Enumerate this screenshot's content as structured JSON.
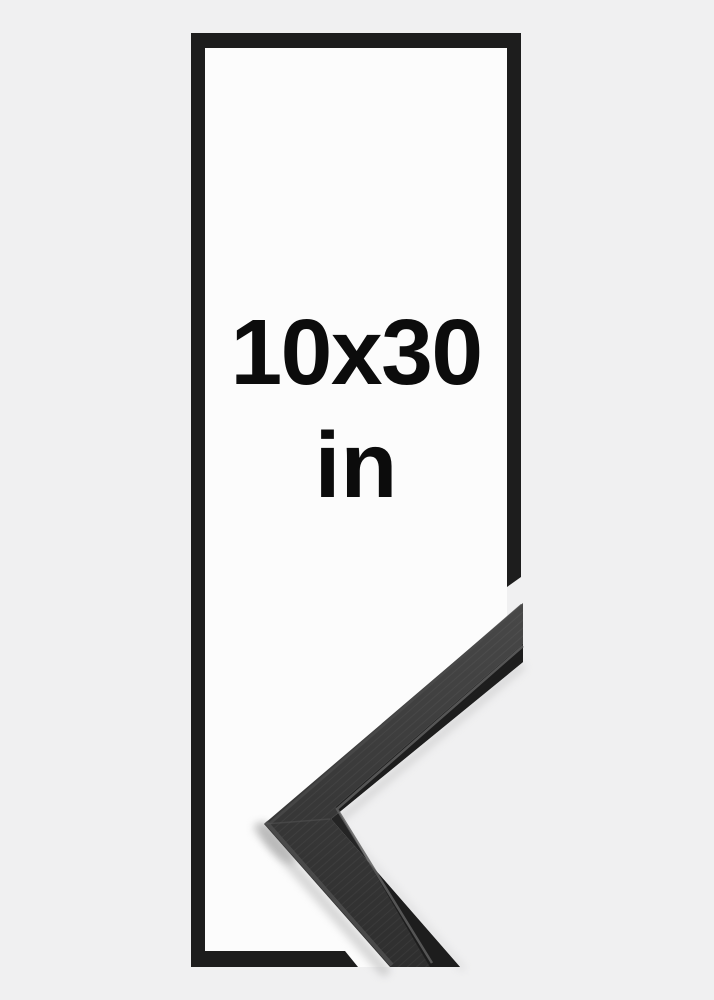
{
  "product_image": {
    "size_label": "10x30",
    "unit_label": "in"
  },
  "colors": {
    "background": "#f0f0f1",
    "frame_interior": "#fcfcfc",
    "frame_outline": "#1d1d1d",
    "text": "#0c0c0c",
    "moulding_face_light": "#474747",
    "moulding_face_mid": "#383838",
    "moulding_face_dark": "#2d2d2d",
    "moulding_inner_strip": "#1c1c1c",
    "moulding_highlight": "#5f5f5f"
  }
}
